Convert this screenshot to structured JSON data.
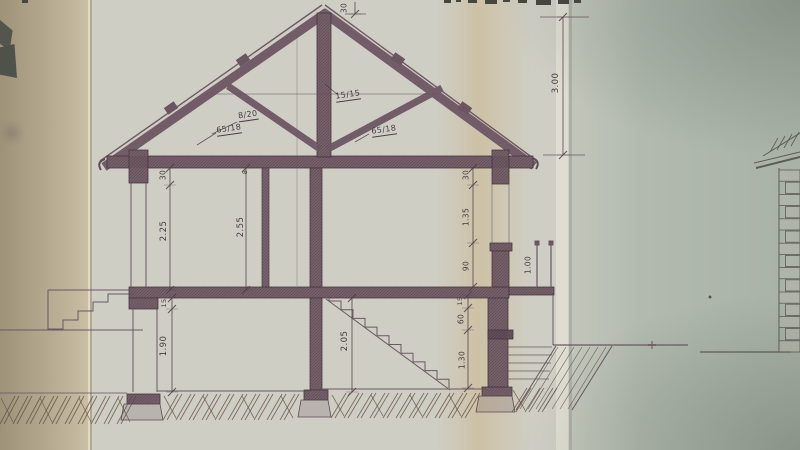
{
  "palette": {
    "ink": "#5d4b55",
    "member_fill": "#77626c",
    "paper_main": "#cfcec5",
    "paper_left_band": "#b2a78c",
    "paper_right_band": "#aeb6ab",
    "soil_hatch": "#5f4e40"
  },
  "section": {
    "truss": {
      "rafter": "8/20",
      "strut_left": "65/18",
      "king_post": "15/15",
      "strut_right": "65/18"
    },
    "roof_dims": {
      "ridge_depth": "30",
      "roof_height": "3.00"
    },
    "upper_floor": {
      "left_lintel": "30",
      "left_opening_height": "2.25",
      "left_slab": "8",
      "storey_height": "2.55",
      "right_lintel": "30",
      "window_height": "1.35",
      "parapet_height": "90",
      "railing_height": "1.00"
    },
    "basement": {
      "left_slab": "15",
      "left_room_height": "1.90",
      "mid_room_height": "2.05",
      "right_slab": "15",
      "right_upper": "60",
      "right_lower": "1.30"
    }
  }
}
